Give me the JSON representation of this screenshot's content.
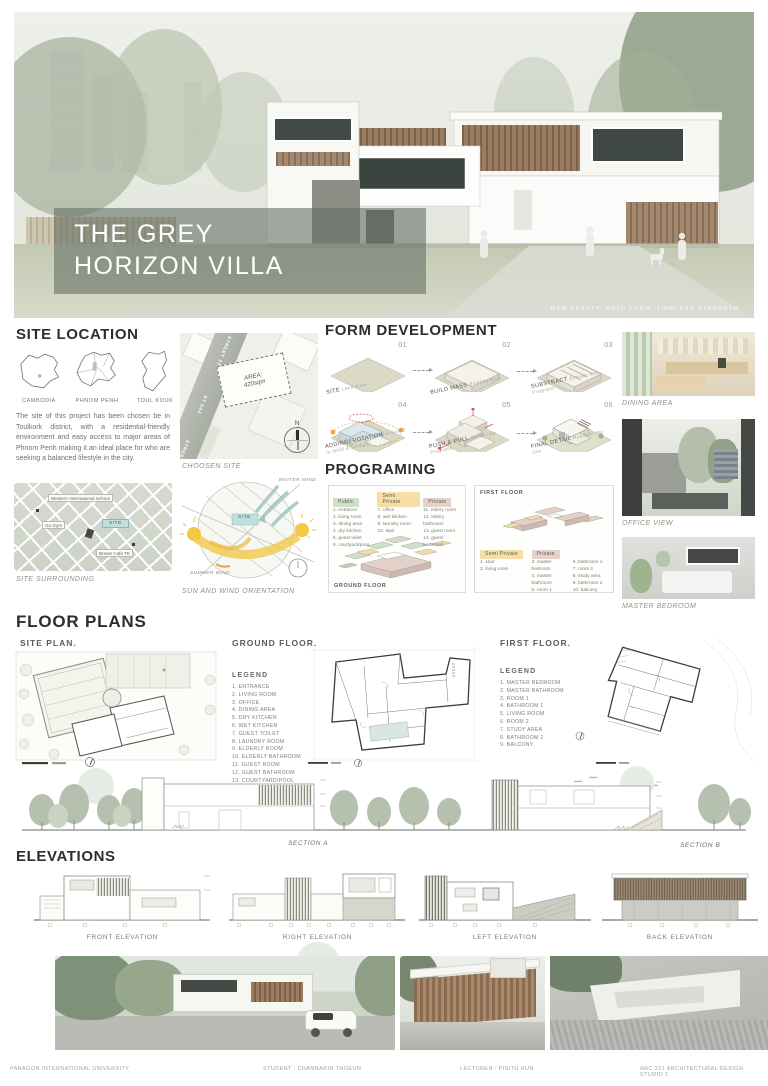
{
  "hero": {
    "line1": "THE GREY",
    "line2": "HORIZON VILLA",
    "tagline": "RAW BEAUTY. BOLD FORM. TIMELESS STRENGTH."
  },
  "site_location": {
    "heading": "SITE LOCATION",
    "map_labels": [
      "CAMBODIA",
      "PHNOM PENH",
      "TOUL KOUK"
    ],
    "description": "The site of this project has been chosen be in Toulkork district, with a residential-friendly environment and easy access to major areas of Phnom Penh making it an ideal place for who are seeking a balanced lifestyle in the city.",
    "surrounding": {
      "school": "Western International School",
      "gym": "Go Gym",
      "site": "SITE",
      "cafe": "Brown Cafe TK"
    },
    "surrounding_caption": "SITE SURROUNDING"
  },
  "choosen_site": {
    "street_1": "STREET 335",
    "street_2": "ST 544",
    "street_3": "STREET 31",
    "area_1": "AREA:",
    "area_2": "420sqm",
    "north": "N",
    "caption": "CHOOSEN SITE"
  },
  "sun_wind": {
    "winter": "WINTER WIND",
    "summer": "SUMMER WIND",
    "site_chip": "SITE",
    "caption": "SUN AND WIND ORIENTATION"
  },
  "form_development": {
    "heading": "FORM DEVELOPMENT",
    "steps": [
      {
        "num": "01",
        "label": "SITE",
        "note": "Land Area"
      },
      {
        "num": "02",
        "label": "BUILD MASS",
        "note": "Building Area"
      },
      {
        "num": "03",
        "label": "SUBSTRACT",
        "note": "Extrude into Programs"
      },
      {
        "num": "04",
        "label": "ADDING/ ROTATION",
        "note": "Oriented to Wind & Sunlight"
      },
      {
        "num": "05",
        "label": "PUSH & PULL",
        "note": "Divide into Programs"
      },
      {
        "num": "06",
        "label": "FINAL DETAIL",
        "note": "Ready to the Use"
      }
    ]
  },
  "programing": {
    "heading": "PROGRAMING",
    "chips": {
      "public": "Public",
      "semi": "Semi Private",
      "private": "Private"
    },
    "ground_caption": "GROUND FLOOR",
    "first_caption": "FIRST FLOOR",
    "ground_public": [
      "1. entrance",
      "2. living room",
      "3. dining area",
      "4. dry kitchen",
      "5. guest toilet",
      "6. courtyard/pool"
    ],
    "ground_semi": [
      "7. office",
      "8. wet kitchen",
      "9. laundry room",
      "10. stair"
    ],
    "ground_private": [
      "11. eldery room",
      "12. eldery bathroom",
      "13. guest room",
      "14. guest bathroom"
    ],
    "first_semi": [
      "1. stair",
      "2. living room"
    ],
    "first_private": [
      "3. master bedroom",
      "4. master bathroom",
      "5. room 1",
      "6. bathroom 1",
      "7. room 2",
      "8. study area",
      "9. bathroom 2",
      "10. balcony"
    ]
  },
  "photos": [
    {
      "caption": "DINING AREA"
    },
    {
      "caption": "OFFICE VIEW"
    },
    {
      "caption": "MASTER BEDROOM"
    }
  ],
  "floor_plans": {
    "heading": "FLOOR PLANS",
    "site_plan_caption": "SITE PLAN.",
    "ground_caption": "GROUND FLOOR.",
    "first_caption": "FIRST FLOOR.",
    "legend_label": "LEGEND",
    "ground_legend": [
      "1. ENTRANCE",
      "2. LIVING ROOM",
      "3. OFFICE",
      "4. DINING AREA",
      "5. DRY KITCHEN",
      "6. WET KITCHEN",
      "7. GUEST TOILET",
      "8. LAUNDRY ROOM",
      "9. ELDERLY ROOM",
      "10. ELDERLY BATHROOM",
      "11. GUEST ROOM",
      "12. GUEST BATHROOM",
      "13. COURTYARD/POOL",
      "14. GARAGE",
      "15. TERRACE"
    ],
    "first_legend": [
      "1. MASTER BEDROOM",
      "2. MASTER BATHROOM",
      "3. ROOM 1",
      "4. BATHROOM 1",
      "5. LIVING ROOM",
      "6. ROOM 2",
      "7. STUDY AREA",
      "8. BATHROOM 2",
      "9. BALCONY"
    ]
  },
  "sections": {
    "a": "SECTION A",
    "b": "SECTION B"
  },
  "elevations": {
    "heading": "ELEVATIONS",
    "captions": [
      "FRONT ELEVATION",
      "RIGHT ELEVATION",
      "LEFT ELEVATION",
      "BACK ELEVATION"
    ]
  },
  "footer": {
    "university": "PARAGON INTERNATIONAL UNIVERSITY",
    "student": "STUDENT : CHANNARIN THOEUN",
    "lecturer": "LECTURER : PISITH HUN",
    "course": "ARC 231 ARCHITECTURAL DESIGN STUDIO 1"
  },
  "colors": {
    "public_green": "#cfe0c8",
    "semi_private_yellow": "#f5dfa6",
    "private_pink": "#e6d2ca",
    "site_teal": "#bfe0dd",
    "title_overlay": "#636d63",
    "sun_yellow": "#f0c84a",
    "wind_blue": "#9fc6c0"
  }
}
